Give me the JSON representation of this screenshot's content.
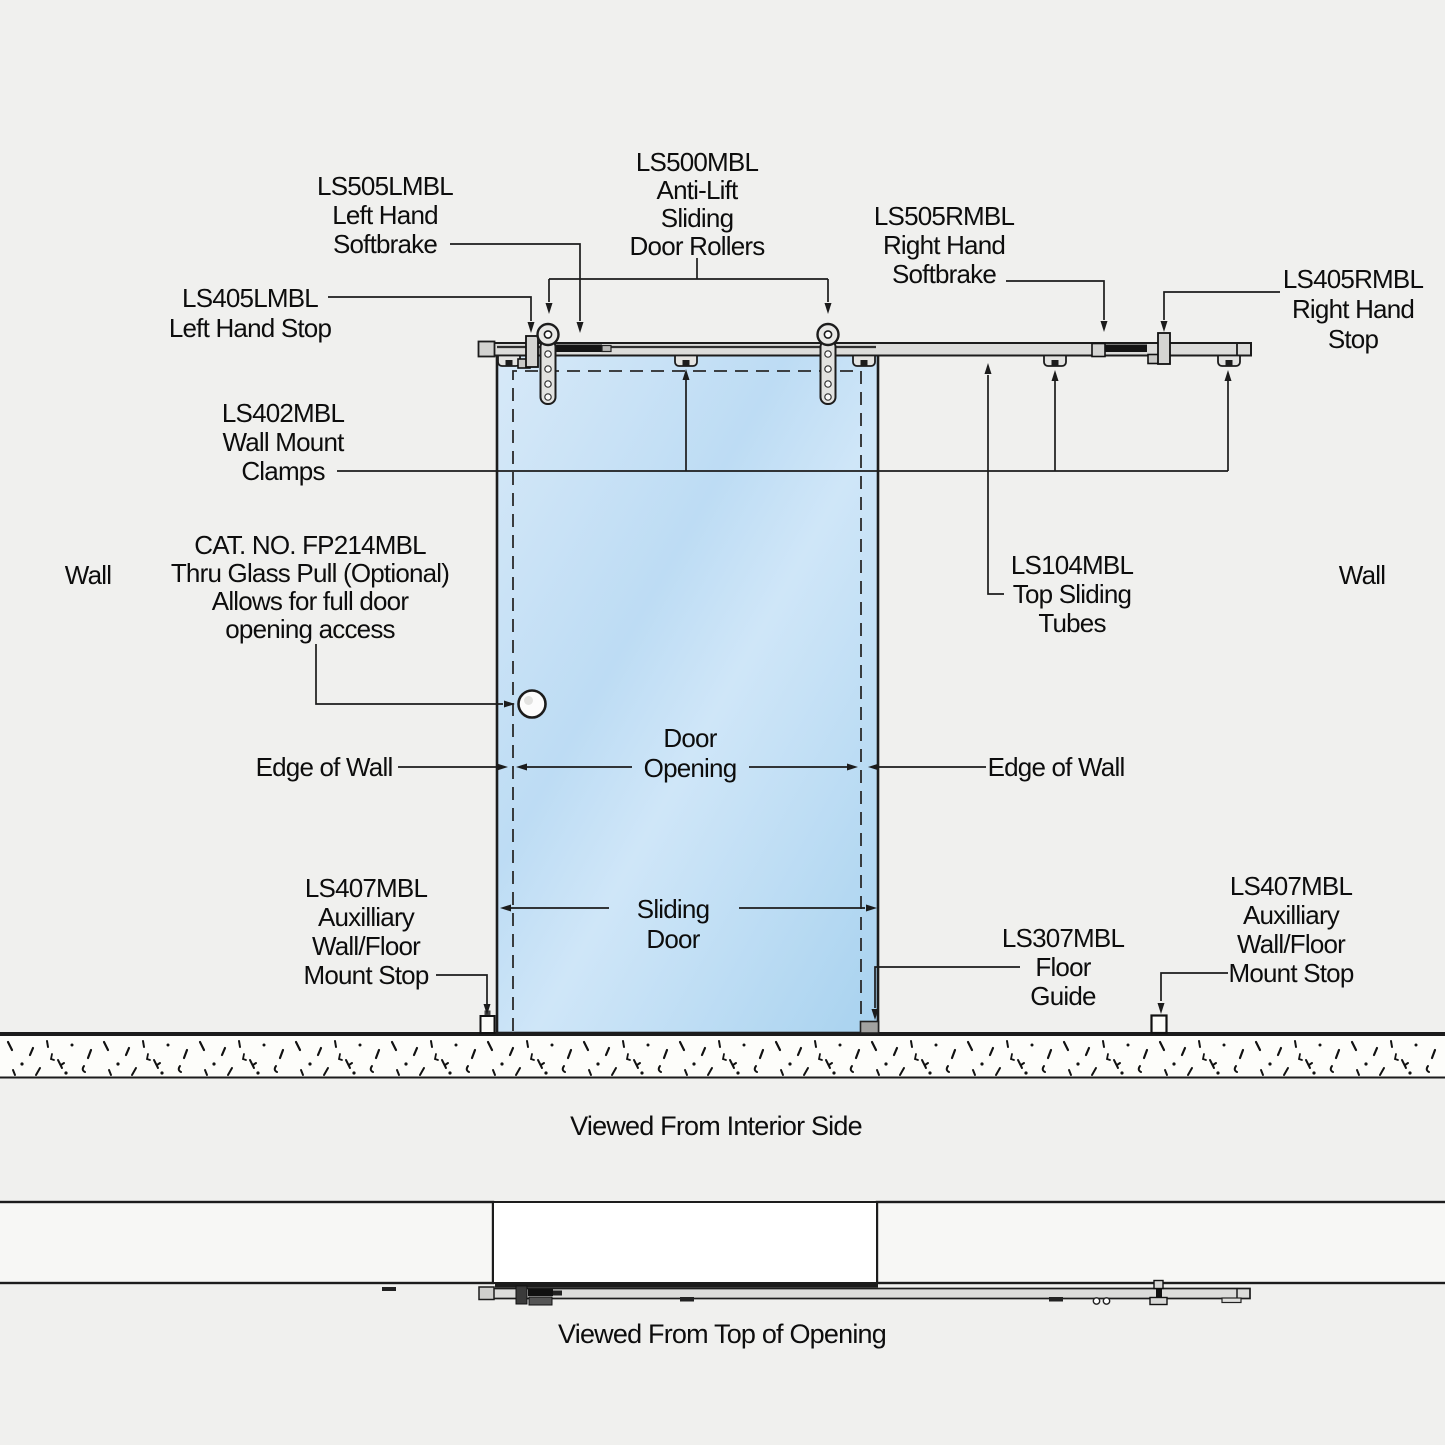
{
  "labels": {
    "ls505l": {
      "lines": [
        "LS505LMBL",
        "Left Hand",
        "Softbrake"
      ]
    },
    "ls500": {
      "lines": [
        "LS500MBL",
        "Anti-Lift",
        "Sliding",
        "Door Rollers"
      ]
    },
    "ls505r": {
      "lines": [
        "LS505RMBL",
        "Right Hand",
        "Softbrake"
      ]
    },
    "ls405r": {
      "lines": [
        "LS405RMBL",
        "Right Hand",
        "Stop"
      ]
    },
    "ls405l": {
      "lines": [
        "LS405LMBL",
        "Left Hand Stop"
      ]
    },
    "ls402": {
      "lines": [
        "LS402MBL",
        "Wall Mount",
        "Clamps"
      ]
    },
    "wall_left": "Wall",
    "wall_right": "Wall",
    "fp214": {
      "lines": [
        "CAT. NO. FP214MBL",
        "Thru Glass Pull (Optional)",
        "Allows for full door",
        "opening access"
      ]
    },
    "ls104": {
      "lines": [
        "LS104MBL",
        "Top Sliding",
        "Tubes"
      ]
    },
    "edge_of_wall_left": "Edge of Wall",
    "edge_of_wall_right": "Edge of Wall",
    "door_opening": {
      "lines": [
        "Door",
        "Opening"
      ]
    },
    "sliding_door": {
      "lines": [
        "Sliding",
        "Door"
      ]
    },
    "ls407_left": {
      "lines": [
        "LS407MBL",
        "Auxilliary",
        "Wall/Floor",
        "Mount Stop"
      ]
    },
    "ls407_right": {
      "lines": [
        "LS407MBL",
        "Auxilliary",
        "Wall/Floor",
        "Mount Stop"
      ]
    },
    "ls307": {
      "lines": [
        "LS307MBL",
        "Floor",
        "Guide"
      ]
    }
  },
  "captions": {
    "interior": "Viewed From Interior Side",
    "top_of_opening": "Viewed From Top of Opening"
  },
  "colors": {
    "background": "#f0f0ee",
    "glass_blue": "#bcdcf5",
    "line_black": "#1c1c1c",
    "track_gray": "#dcdcda",
    "floor_guide_gray": "#a2a2a0"
  }
}
